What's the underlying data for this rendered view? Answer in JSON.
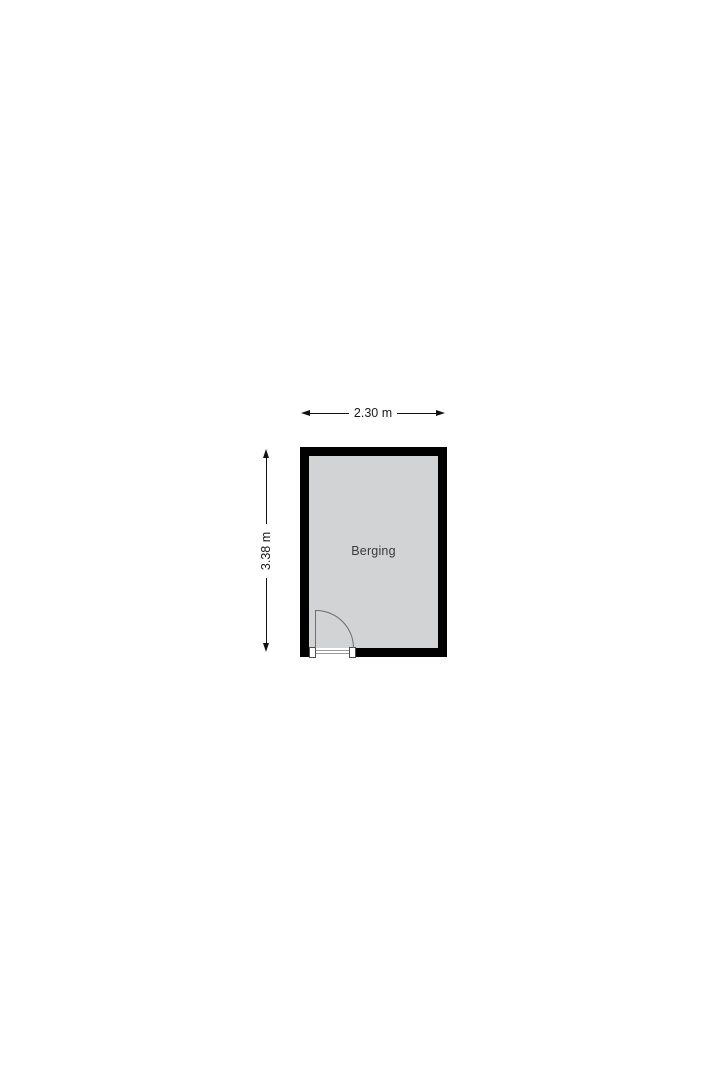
{
  "floorplan": {
    "room": {
      "label": "Berging"
    },
    "dimensions": {
      "width": {
        "label": "2.30 m"
      },
      "height": {
        "label": "3.38 m"
      }
    },
    "colors": {
      "wall": "#000000",
      "room_fill": "#d1d3d4",
      "dim_line": "#111111",
      "dim_text": "#1a1a1a",
      "room_text": "#3a3a3a",
      "door_line": "#6e6e6e",
      "sill_line": "#9a9a9a",
      "background": "#ffffff"
    }
  }
}
